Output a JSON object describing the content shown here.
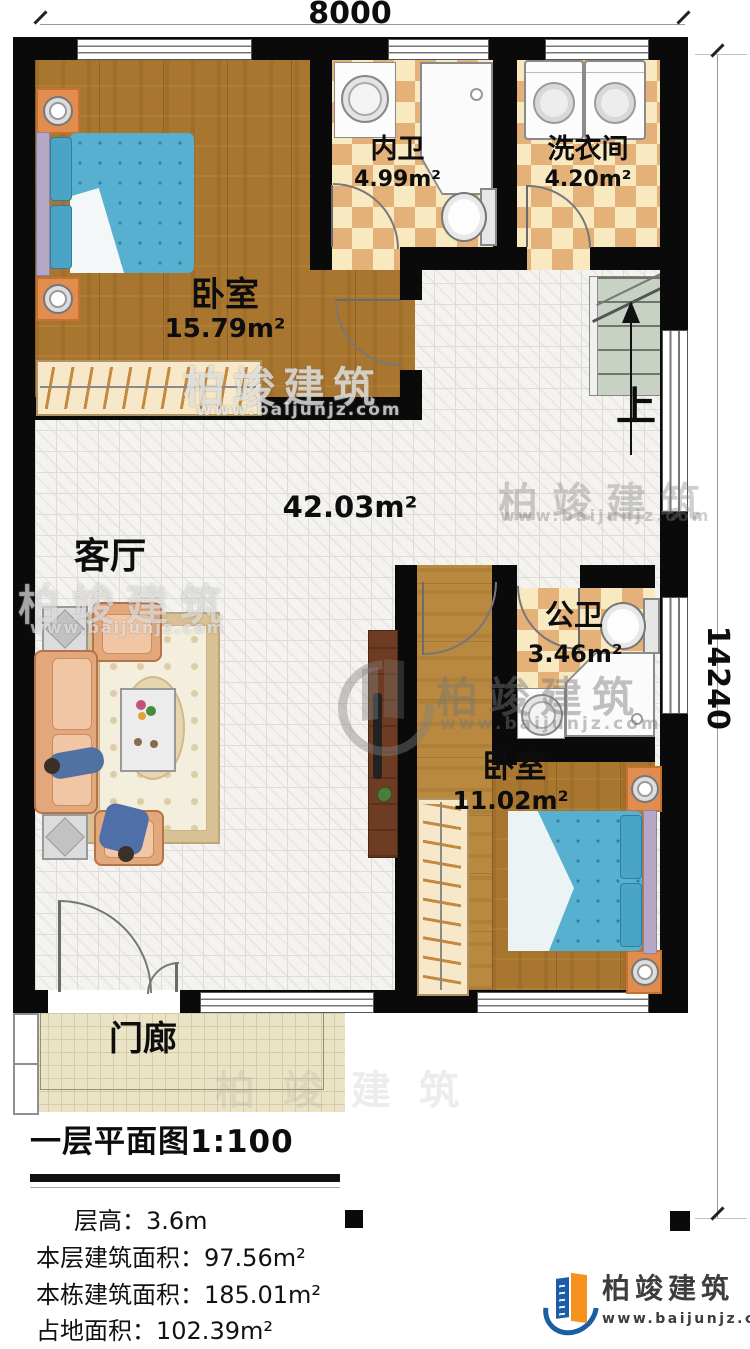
{
  "dimensions": {
    "width_label": "8000",
    "height_label": "14240"
  },
  "rooms": {
    "bedroom1": {
      "name": "卧室",
      "area": "15.79m²"
    },
    "ensuite_bath": {
      "name": "内卫",
      "area": "4.99m²"
    },
    "laundry": {
      "name": "洗衣间",
      "area": "4.20m²"
    },
    "living": {
      "name": "客厅",
      "area": "42.03m²"
    },
    "public_bath": {
      "name": "公卫",
      "area": "3.46m²"
    },
    "bedroom2": {
      "name": "卧室",
      "area": "11.02m²"
    },
    "porch": {
      "name": "门廊"
    }
  },
  "stairs": {
    "direction_label": "上"
  },
  "title_block": {
    "title": "一层平面图1:100",
    "stats": [
      {
        "label": "层高：",
        "value": "3.6m"
      },
      {
        "label": "本层建筑面积：",
        "value": "97.56m²"
      },
      {
        "label": "本栋建筑面积：",
        "value": "185.01m²"
      },
      {
        "label": "占地面积：",
        "value": "102.39m²"
      }
    ]
  },
  "branding": {
    "name": "柏竣建筑",
    "url": "www.baijunjz.com"
  },
  "watermarks": {
    "brand": "柏竣建筑",
    "url": "www.baijunjz.com"
  },
  "colors": {
    "accent_blue": "#1b5ea6",
    "accent_orange": "#f6921e",
    "wall": "#0a0a0a"
  }
}
